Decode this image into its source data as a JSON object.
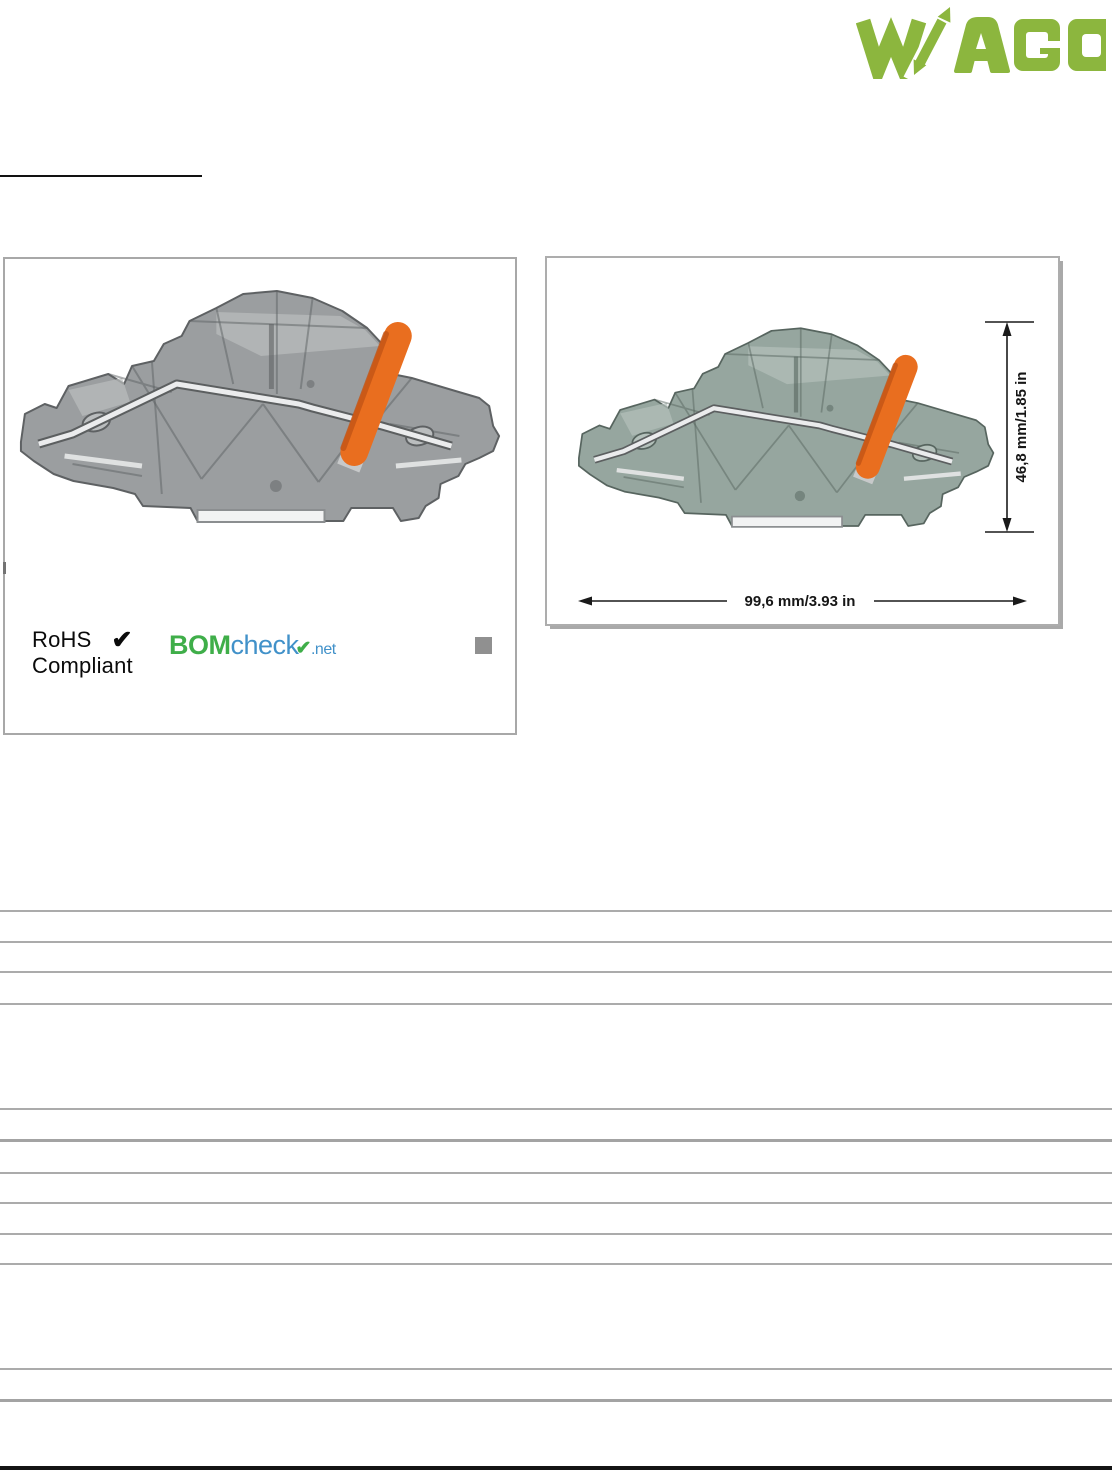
{
  "header": {
    "brand": "WAGO"
  },
  "left_panel": {
    "rohs": {
      "line1": "RoHS",
      "line2": "Compliant",
      "check": "✔"
    },
    "bomcheck": {
      "bom": "BOM",
      "check_word": "check",
      "check_mark": "✔",
      "net": ".net"
    }
  },
  "right_panel": {
    "height_dimension_label": "46,8 mm/1.85 in",
    "width_dimension_label": "99,6 mm/3.93 in"
  },
  "colors": {
    "wago_green": "#8CB63E",
    "lever_orange": "#E96E1F",
    "body_gray_left": "#9B9EA0",
    "body_gray_right": "#96A69F",
    "bomcheck_green": "#3FAE49",
    "bomcheck_blue": "#4191C9",
    "rule_gray": "#ABABAB"
  }
}
